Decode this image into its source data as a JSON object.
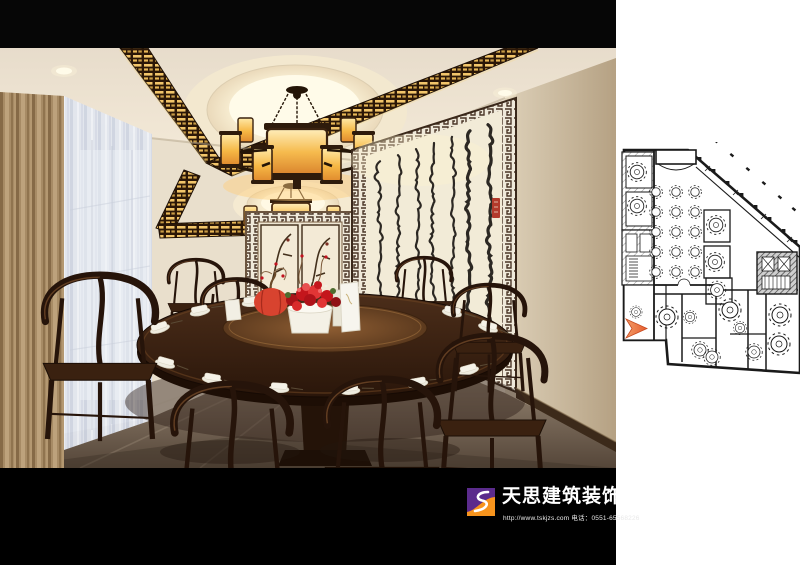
{
  "footer": {
    "brand_name": "天思建筑装饰",
    "website": "http://www.tskjzs.com",
    "phone_label": "电话：0551-65568226",
    "bar_color": "#000000",
    "logo": {
      "purple": "#5b2b8c",
      "orange": "#f7941d",
      "mark_color": "#ffffff"
    }
  },
  "rendering": {
    "scene_name": "chinese-restaurant-private-dining-room",
    "key_colors": {
      "ceiling_black_band": "#060606",
      "ceiling_cream": "#f0e7d6",
      "lantern_glow": "#f6bb4e",
      "fretwork_gold": "#f2c56a",
      "dark_wood": "#2c190c",
      "curtain_tan": "#b89c72",
      "sheer_curtain": "#dfe3ec",
      "wall_beige": "#e9dfcc",
      "calligraphy_paper": "#f2ebd7",
      "calligraphy_ink": "#1b1713",
      "seal_red": "#b3392b",
      "flowers_red": "#c4161c",
      "floor_taupe": "#8d7c6a"
    }
  },
  "floor_plan": {
    "drawing_name": "restaurant-floor-plan",
    "ink_color": "#1a1a1a",
    "marker_color": "#e65c2e",
    "hall_tables": {
      "cols": 3,
      "rows": 5
    }
  }
}
